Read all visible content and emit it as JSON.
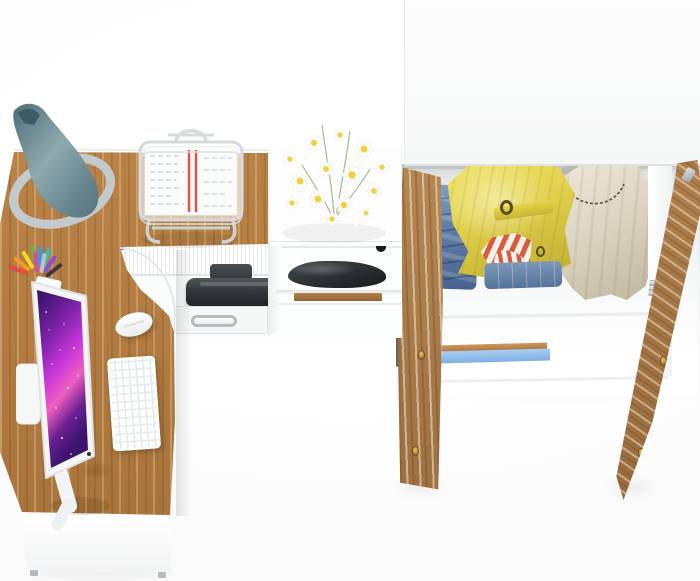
{
  "scene": {
    "view": "top-down render of home office furniture set",
    "objects": {
      "desk": {
        "label": "l-shaped-wood-desk",
        "wood_color": "#b27c42",
        "front_panel_color": "#ffffff"
      },
      "desk_lamp": {
        "label": "teal-cone-desk-lamp",
        "shade_color": "#6f8c92",
        "base_color": "#c3cbcd"
      },
      "monitor": {
        "label": "white-monitor-with-galaxy-wallpaper",
        "bezel_color": "#f3f5f6",
        "screen_colors": [
          "#30125e",
          "#a62bbf",
          "#ef5fc0",
          "#3c1470"
        ]
      },
      "keyboard": {
        "label": "white-keyboard",
        "color": "#fdfefe"
      },
      "mouse": {
        "label": "white-mouse",
        "color": "#ffffff"
      },
      "pencil_cup": {
        "label": "pencil-cup-with-pens",
        "pen_colors": [
          "#e8483f",
          "#f59a23",
          "#f5d928",
          "#61b54a",
          "#3f9bd8",
          "#2bc4c4",
          "#8a4fd0",
          "#3a3a3a",
          "#d84b9e",
          "#c0c4c6"
        ]
      },
      "document_tray": {
        "label": "wire-document-tray-with-papers",
        "wire_color": "#d5dadc",
        "paper_color": "#fafbfb",
        "stripe_color": "#e25347"
      },
      "flowers": {
        "label": "white-daisy-bouquet",
        "petal_color": "#ffffff",
        "center_color": "#f0d23c",
        "stem_color": "#8aa86c"
      },
      "binders": {
        "label": "binders-with-colored-tabs",
        "tab_colors": [
          "#e8557e",
          "#c94fd0",
          "#e8473f",
          "#f5c93a",
          "#35b4c8",
          "#3f6fd8",
          "#57c04f",
          "#f08c28",
          "#e8557e",
          "#f5e04a",
          "#4fc0b0",
          "#5a82e0",
          "#e8644a",
          "#8a52c8"
        ]
      },
      "printer": {
        "label": "dark-printer-on-shelf",
        "color": "#33383c"
      },
      "drawer": {
        "label": "white-drawer-with-metal-handle",
        "handle_color": "#b7bcc0"
      },
      "shoe": {
        "label": "dark-shoe-in-cubby",
        "color": "#2b2f32"
      },
      "wardrobe": {
        "label": "open-wardrobe-with-clothes",
        "top_color": "#fbfbfc",
        "door_wood_color": "#a97c49",
        "knob_color": "#c79b3f",
        "hinge_color": "#aab0b5"
      },
      "clothes": {
        "jeans_stack": {
          "label": "folded-jeans-stack",
          "color": "#5d7ca6"
        },
        "yellow_jacket": {
          "label": "yellow-belted-jacket",
          "color": "#e3d34f"
        },
        "striped_item": {
          "label": "red-white-striped-garment",
          "color": "#d95b3c"
        },
        "folded_jeans": {
          "label": "folded-jeans",
          "color": "#54719a"
        },
        "beige_coat": {
          "label": "beige-hanging-coat",
          "color": "#ddd6c4"
        },
        "blue_blanket": {
          "label": "blue-folded-blanket-on-shelf",
          "color": "#8fbcec"
        }
      }
    },
    "colors": {
      "background": "#fdfdfd",
      "wood": "#b27c42",
      "door_wood": "#a97c49",
      "accent_red": "#e25347",
      "denim": "#5d7ca6",
      "yellow": "#e3d34f",
      "cream": "#ddd6c4",
      "blue": "#8fbcec",
      "brass": "#c79b3f"
    }
  }
}
